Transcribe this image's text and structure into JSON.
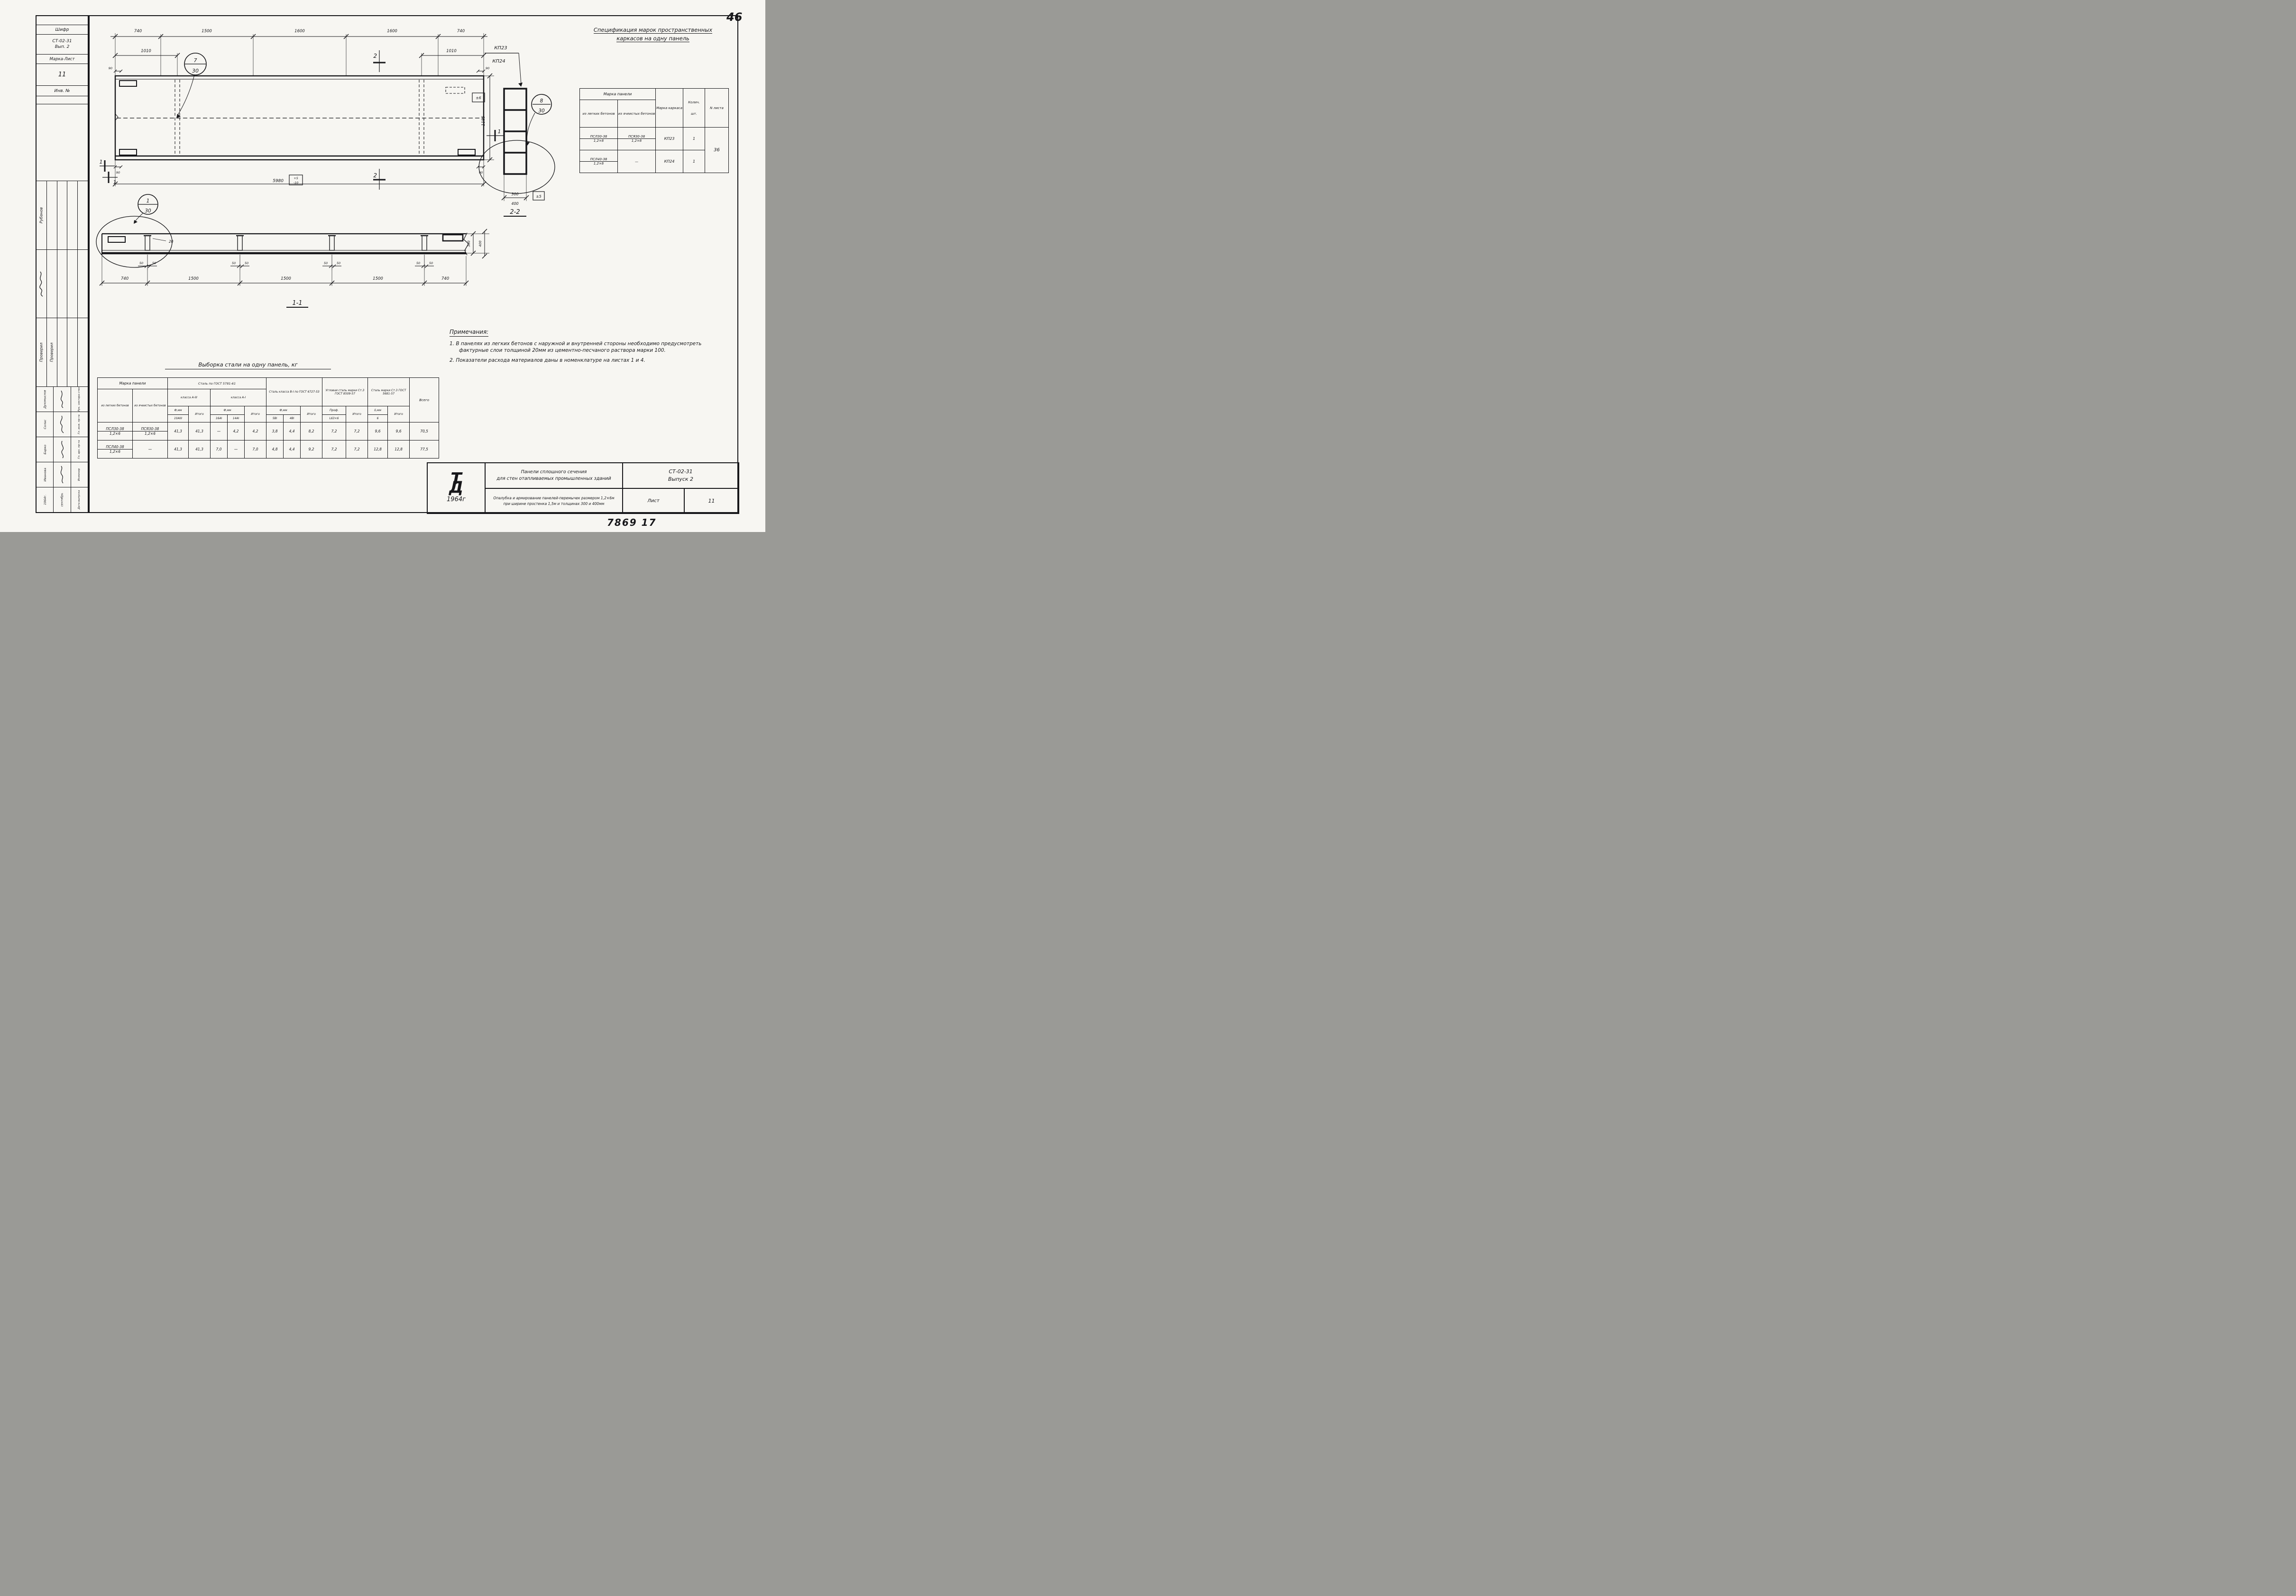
{
  "sheet": {
    "page_number": "46",
    "doc_number": "7869 17"
  },
  "sidebar": {
    "shifr_label": "Шифр",
    "shifr_value1": "СТ-02-31",
    "shifr_value2": "Вып. 2",
    "marka_label": "Марка-Лист",
    "marka_value": "11",
    "inv_label": "Инв. №",
    "mid_r1": "Рубанов",
    "mid_r3a": "Проверил",
    "mid_r3b": "Проверил",
    "people_names": [
      "Духомыслов",
      "Солас",
      "Барко",
      "Иванова",
      "1964г."
    ],
    "people_middle": [
      "",
      "",
      "",
      "",
      "сентябрь"
    ],
    "people_titles": [
      "Рук. сектора стен",
      "Гл. инж. пр-та",
      "Гл. арх. пр-та",
      "Инженер",
      "Дата выпуска"
    ]
  },
  "plan": {
    "dims_top": [
      "740",
      "1500",
      "1600",
      "1600",
      "740"
    ],
    "dim_1010_left": "1010",
    "dim_1010_right": "1010",
    "dim_90": "90",
    "dim_total": "5980",
    "tol_plus": "+5",
    "tol_minus": "-10",
    "dim_height": "1185",
    "tol_height": "±6",
    "callout_top": "7",
    "callout_bottom": "30",
    "mark2": "2",
    "mark1": "1"
  },
  "section22": {
    "label": "2-2",
    "kp23": "КП23",
    "kp24": "КП24",
    "callout_top": "8",
    "callout_bottom": "30",
    "dim300": "300",
    "dim400": "400",
    "tol": "±5"
  },
  "section11": {
    "label": "1-1",
    "callout_top": "1",
    "callout_bottom": "30",
    "dim20": "20",
    "dim50": "50",
    "dims_bottom": [
      "740",
      "1500",
      "1500",
      "1500",
      "740"
    ],
    "dim300": "300",
    "dim400": "400"
  },
  "spec_table": {
    "title1": "Спецификация марок пространственных",
    "title2": "каркасов на одну панель",
    "h_marka": "Марка панели",
    "h_light": "из легких бетонов",
    "h_cell": "из ячеистых бетонов",
    "h_karkas": "Марка каркаса",
    "h_qty1": "Колич.",
    "h_qty2": "шт.",
    "h_sheet": "N листа",
    "rows": [
      {
        "p1a": "ПСЛ30-38",
        "p1b": "1,2×6",
        "p2a": "ПСЯ30-38",
        "p2b": "1,2×6",
        "karkas": "КП23",
        "qty": "1"
      },
      {
        "p1a": "ПСЛ40-38",
        "p1b": "1,2×6",
        "p2a": "—",
        "p2b": "",
        "karkas": "КП24",
        "qty": "1"
      }
    ],
    "sheet_no": "36"
  },
  "steel_table": {
    "title": "Выборка стали на одну панель, кг",
    "h_marka": "Марка панели",
    "h_light": "из легких бетонов",
    "h_cell": "из ячеистых бетонов",
    "g_gost5781": "Сталь по ГОСТ 5781-61",
    "g_a3": "класса А-III",
    "g_a1": "класса А-I",
    "g_b1": "Сталь класса В-I по ГОСТ 6727-53",
    "g_ugol": "Угловая сталь марки Ст.3 ГОСТ 8509-57",
    "g_st3": "Сталь марки Ст.3 ГОСТ 5681-57",
    "h_vsego": "Всего",
    "h_f": "Ф,мм",
    "h_itogo": "Итого",
    "h_prof": "Проф.",
    "h_b": "δ,мм",
    "d_10a3": "10АIII",
    "d_16a1": "16АI",
    "d_14a1": "14АI",
    "d_5b1": "5ВI",
    "d_4b1": "4ВI",
    "d_l63": "L63×6",
    "d_6": "6",
    "rows": [
      {
        "p1a": "ПСЛ30-38",
        "p1b": "1,2×6",
        "p2a": "ПСЯ30-38",
        "p2b": "1,2×6",
        "vals": [
          "41,3",
          "41,3",
          "—",
          "4,2",
          "4,2",
          "3,8",
          "4,4",
          "8,2",
          "7,2",
          "7,2",
          "9,6",
          "9,6",
          "70,5"
        ]
      },
      {
        "p1a": "ПСЛ40-38",
        "p1b": "1,2×6",
        "p2a": "—",
        "p2b": "",
        "vals": [
          "41,3",
          "41,3",
          "7,0",
          "—",
          "7,0",
          "4,8",
          "4,4",
          "9,2",
          "7,2",
          "7,2",
          "12,8",
          "12,8",
          "77,5"
        ]
      }
    ]
  },
  "notes": {
    "title": "Примечания:",
    "item1": "1.  В панелях из легких бетонов с наружной и внутренней стороны необходимо предусмотреть фактурные слои толщиной 20мм из цементно-песчаного раствора марки 100.",
    "item2": "2.  Показатели расхода материалов даны в номенклатуре на листах 1 и 4."
  },
  "title_block": {
    "logo_t": "Т",
    "logo_d": "Д",
    "year": "1964г",
    "t1": "Панели сплошного сечения",
    "t2": "для стен отапливаемых промышленных зданий",
    "code": "СТ-02-31",
    "issue": "Выпуск 2",
    "d1": "Опалубка и армирование панелей-перемычек размером 1,2×6м",
    "d2": "при ширине простенка 1,5м и толщинах 300 и 400мм",
    "list_label": "Лист",
    "list_value": "11"
  }
}
